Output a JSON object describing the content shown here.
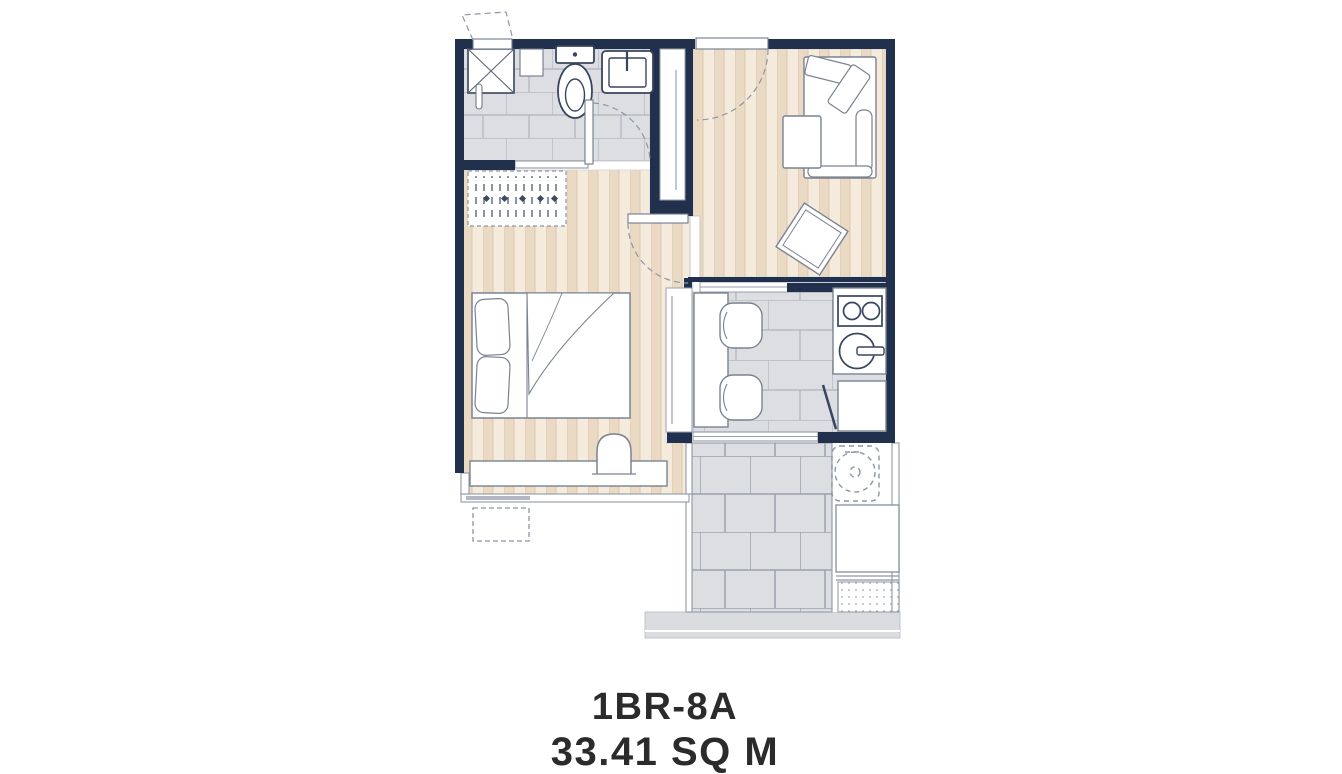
{
  "caption": {
    "unit_name": "1BR-8A",
    "unit_area": "33.41 SQ M"
  },
  "floor_plan": {
    "type": "apartment-unit-plan",
    "rooms": [
      "bathroom",
      "bedroom",
      "living-room",
      "kitchen",
      "balcony"
    ],
    "fixtures": [
      "entrance-door",
      "shower",
      "toilet",
      "wash-basin",
      "towel-bar",
      "wardrobe",
      "closet",
      "bed",
      "pillows",
      "desk",
      "stool",
      "window",
      "condenser-unit",
      "sofa",
      "coffee-table",
      "side-table",
      "dining-table",
      "dining-chairs",
      "kitchen-counter",
      "cooktop",
      "kitchen-sink",
      "refrigerator",
      "sliding-door",
      "washing-machine",
      "planter-ledge"
    ],
    "colors": {
      "wall": "#20304d",
      "wood_floor": "#ead9c3",
      "wood_floor_light": "#f4ebdd",
      "tile_floor": "#dcdee2",
      "tile_grout": "#b6bac3",
      "balcony_tile": "#dddee1",
      "balcony_grout": "#9ba1ad",
      "fixture_outline": "#39455f",
      "furniture_outline": "#7a8292",
      "dashed_line": "#8d96a4",
      "text": "#2b2b2b",
      "background": "#ffffff"
    }
  }
}
